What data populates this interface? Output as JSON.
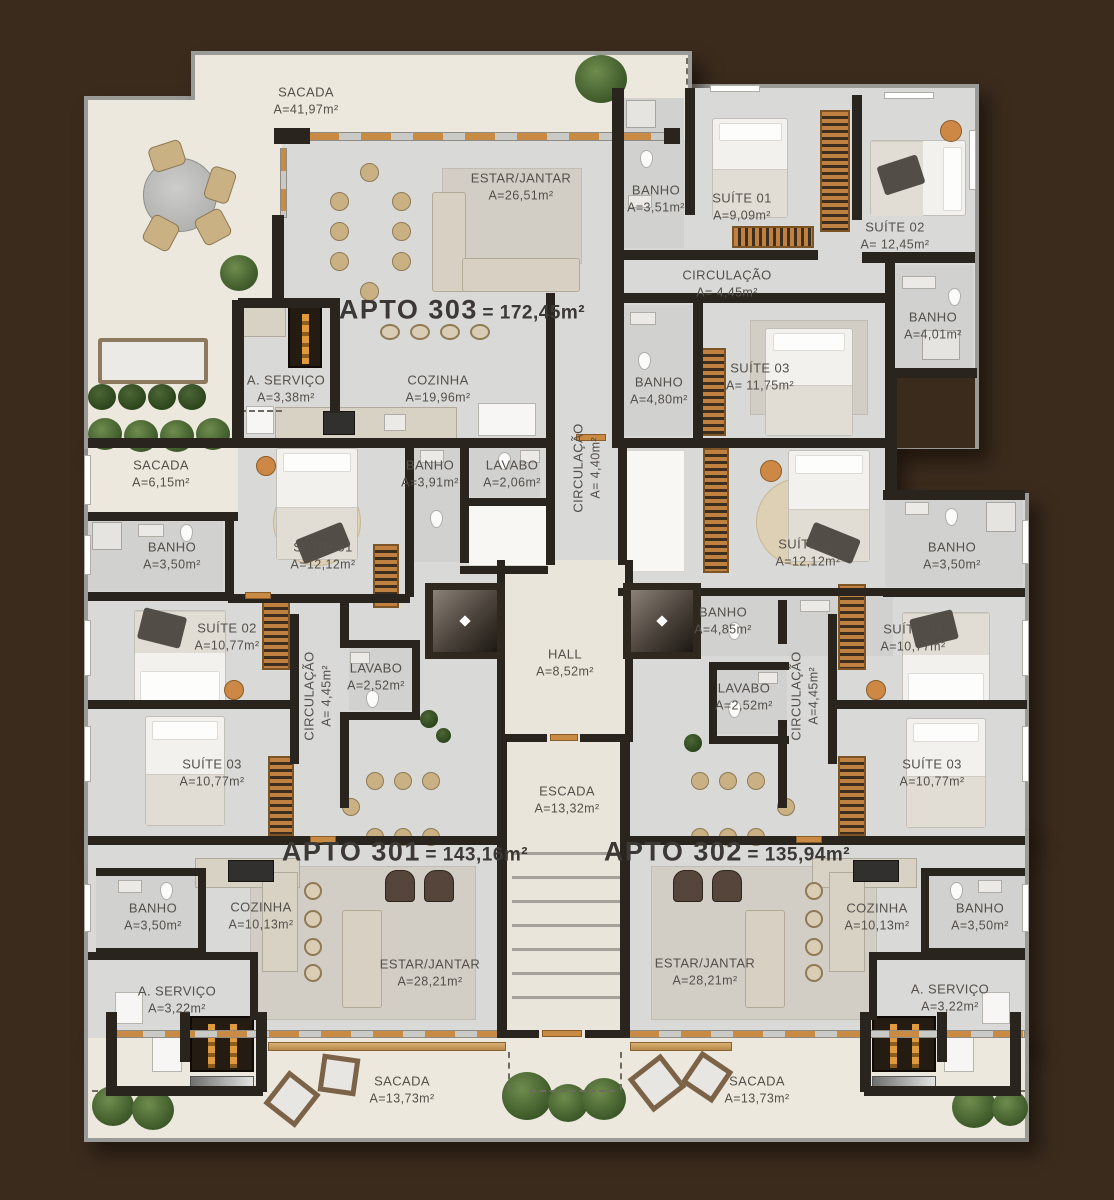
{
  "apartments": {
    "a303": {
      "name": "APTO 303",
      "area": "= 172,45m²"
    },
    "a301": {
      "name": "APTO 301",
      "area": "= 143,16m²"
    },
    "a302": {
      "name": "APTO 302",
      "area": "= 135,94m²"
    }
  },
  "rooms": {
    "sacada_terraco": {
      "name": "SACADA",
      "area": "A=41,97m²"
    },
    "estar_303": {
      "name": "ESTAR/JANTAR",
      "area": "A=26,51m²"
    },
    "banho_303a": {
      "name": "BANHO",
      "area": "A=3,51m²"
    },
    "suite1_303": {
      "name": "SUÍTE 01",
      "area": "A=9,09m²"
    },
    "suite2_303": {
      "name": "SUÍTE 02",
      "area": "A= 12,45m²"
    },
    "circ_303": {
      "name": "CIRCULAÇÃO",
      "area": "A= 4,45m²"
    },
    "banho_303b": {
      "name": "BANHO",
      "area": "A=4,01m²"
    },
    "servico_303": {
      "name": "A. SERVIÇO",
      "area": "A=3,38m²"
    },
    "cozinha_303": {
      "name": "COZINHA",
      "area": "A=19,96m²"
    },
    "banho_303c": {
      "name": "BANHO",
      "area": "A=4,80m²"
    },
    "suite3_303": {
      "name": "SUÍTE 03",
      "area": "A= 11,75m²"
    },
    "sacada_lateral": {
      "name": "SACADA",
      "area": "A=6,15m²"
    },
    "banho_391": {
      "name": "BANHO",
      "area": "A=3,91m²"
    },
    "lavabo_206": {
      "name": "LAVABO",
      "area": "A=2,06m²"
    },
    "circ_440": {
      "name": "CIRCULAÇÃO",
      "area": "A= 4,40m²"
    },
    "banho_350_a": {
      "name": "BANHO",
      "area": "A=3,50m²"
    },
    "suite1_301": {
      "name": "SUÍTE 01",
      "area": "A=12,12m²"
    },
    "suite1_302": {
      "name": "SUÍTE 01",
      "area": "A=12,12m²"
    },
    "banho_350_b": {
      "name": "BANHO",
      "area": "A=3,50m²"
    },
    "suite2_301": {
      "name": "SUÍTE 02",
      "area": "A=10,77m²"
    },
    "banho_485": {
      "name": "BANHO",
      "area": "A=4,85m²"
    },
    "suite2_302": {
      "name": "SUÍTE 02",
      "area": "A=10,77m²"
    },
    "circ_301": {
      "name": "CIRCULAÇÃO",
      "area": "A= 4,45m²"
    },
    "lavabo_301": {
      "name": "LAVABO",
      "area": "A=2,52m²"
    },
    "hall": {
      "name": "HALL",
      "area": "A=8,52m²"
    },
    "lavabo_302": {
      "name": "LAVABO",
      "area": "A=2,52m²"
    },
    "circ_302": {
      "name": "CIRCULAÇÃO",
      "area": "A=4,45m²"
    },
    "suite3_301": {
      "name": "SUÍTE 03",
      "area": "A=10,77m²"
    },
    "suite3_302": {
      "name": "SUÍTE 03",
      "area": "A=10,77m²"
    },
    "escada": {
      "name": "ESCADA",
      "area": "A=13,32m²"
    },
    "banho_350_c": {
      "name": "BANHO",
      "area": "A=3,50m²"
    },
    "cozinha_301": {
      "name": "COZINHA",
      "area": "A=10,13m²"
    },
    "cozinha_302": {
      "name": "COZINHA",
      "area": "A=10,13m²"
    },
    "banho_350_d": {
      "name": "BANHO",
      "area": "A=3,50m²"
    },
    "estar_301": {
      "name": "ESTAR/JANTAR",
      "area": "A=28,21m²"
    },
    "estar_302": {
      "name": "ESTAR/JANTAR",
      "area": "A=28,21m²"
    },
    "servico_301": {
      "name": "A. SERVIÇO",
      "area": "A=3,22m²"
    },
    "servico_302": {
      "name": "A. SERVIÇO",
      "area": "A=3,22m²"
    },
    "sacada_301": {
      "name": "SACADA",
      "area": "A=13,73m²"
    },
    "sacada_302": {
      "name": "SACADA",
      "area": "A=13,73m²"
    }
  },
  "palette": {
    "background": "#3A2B1D",
    "floor": "#D9D9D7",
    "balcony": "#ECE8DD",
    "wall": "#2A241E",
    "wood": "#C98A44",
    "label_text": "#54504B"
  }
}
